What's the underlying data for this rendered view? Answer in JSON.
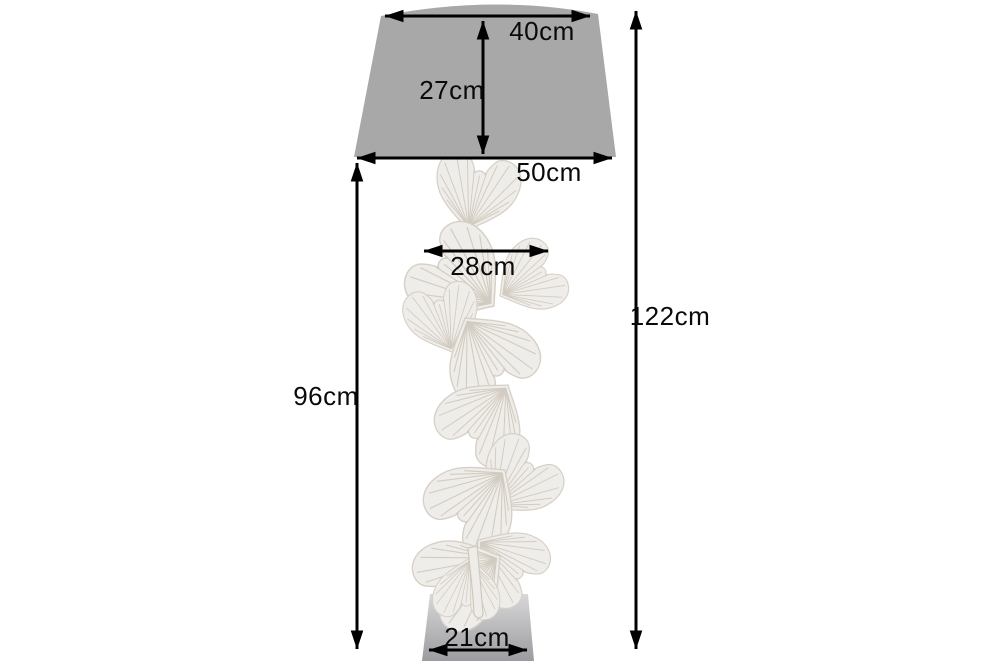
{
  "diagram": {
    "type": "product-dimension-diagram",
    "dimensions": {
      "shade_top_width": "40cm",
      "shade_height": "27cm",
      "shade_bottom_width": "50cm",
      "leaf_width": "28cm",
      "stand_height": "96cm",
      "total_height": "122cm",
      "base_width": "21cm"
    },
    "colors": {
      "background": "#ffffff",
      "shade": "#a8a8a8",
      "leaf_fill": "#efede9",
      "leaf_outline": "#d6d0c6",
      "leaf_vein": "#cfc8bd",
      "base_top": "#d8d8da",
      "base_bottom": "#9c9ca0",
      "dimension_line": "#000000",
      "label_text": "#0a0a0a"
    }
  }
}
